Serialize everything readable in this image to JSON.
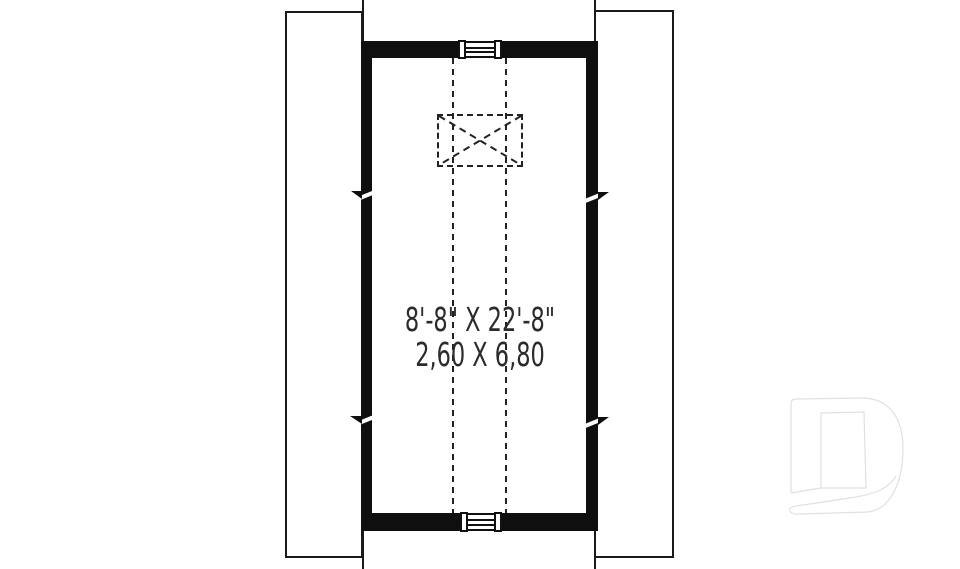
{
  "plan": {
    "room_dimensions_imperial": "8'-8\" X 22'-8\"",
    "room_dimensions_metric": "2,60 X 6,80"
  },
  "symbols": {
    "top_vent": "louvered-gable-vent",
    "bottom_vent": "louvered-gable-vent",
    "attic_access": "dashed-x-box-attic-access",
    "center_lines": "dashed-center-lines",
    "wall_breaks": "wall-break-marks",
    "side_bands": "roof-overhang-bands",
    "watermark": "drummond-d-logo"
  },
  "colors": {
    "background": "#ffffff",
    "wall": "#0f0f0f",
    "line": "#1a1a1a",
    "text": "#2b2b2b",
    "logo_outline": "#e0e0e0"
  }
}
